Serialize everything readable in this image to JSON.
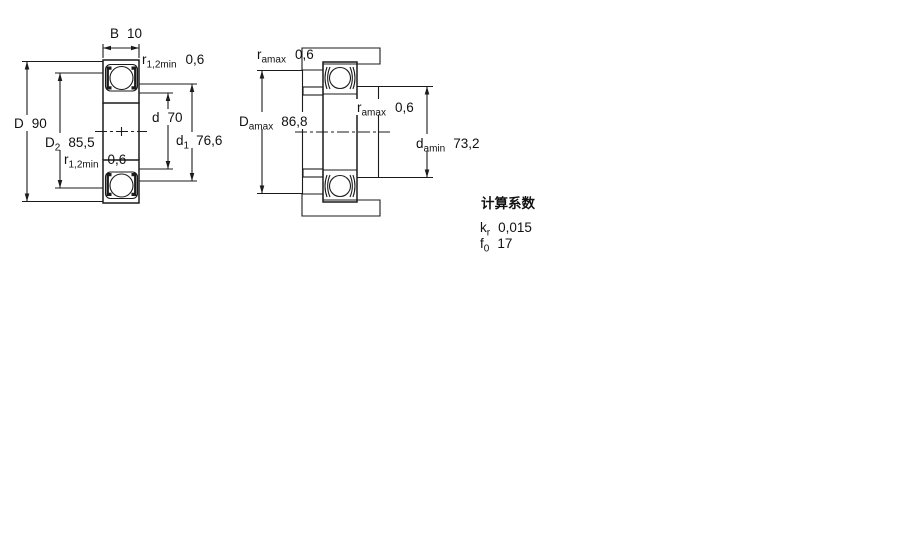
{
  "drawing": {
    "left_view": {
      "width_dim": {
        "sym": "B",
        "val": "10"
      },
      "outer_dia": {
        "sym": "D",
        "val": "90"
      },
      "recess_dia": {
        "sym": "D",
        "sub": "2",
        "val": "85,5"
      },
      "fillet_top": {
        "sym": "r",
        "sub": "1,2min",
        "val": "0,6"
      },
      "fillet_bottom": {
        "sym": "r",
        "sub": "1,2min",
        "val": "0,6"
      },
      "bore_dia": {
        "sym": "d",
        "val": "70"
      },
      "shoulder_dia": {
        "sym": "d",
        "sub": "1",
        "val": "76,6"
      }
    },
    "right_view": {
      "fillet_top": {
        "sym": "r",
        "sub": "amax",
        "val": "0,6"
      },
      "housing_abutment_dia": {
        "sym": "D",
        "sub": "amax",
        "val": "86,8"
      },
      "fillet_mid": {
        "sym": "r",
        "sub": "amax",
        "val": "0,6"
      },
      "shaft_abutment_dia": {
        "sym": "d",
        "sub": "amin",
        "val": "73,2"
      }
    }
  },
  "calculation_factors": {
    "title": "计算系数",
    "items": [
      {
        "sym": "k",
        "sub": "r",
        "val": "0,015"
      },
      {
        "sym": "f",
        "sub": "0",
        "val": "17"
      }
    ]
  },
  "colors": {
    "hatch_fill": "#b7cfe1",
    "hatch_dot": "#6f9cbd",
    "line": "#1b1b1b"
  }
}
